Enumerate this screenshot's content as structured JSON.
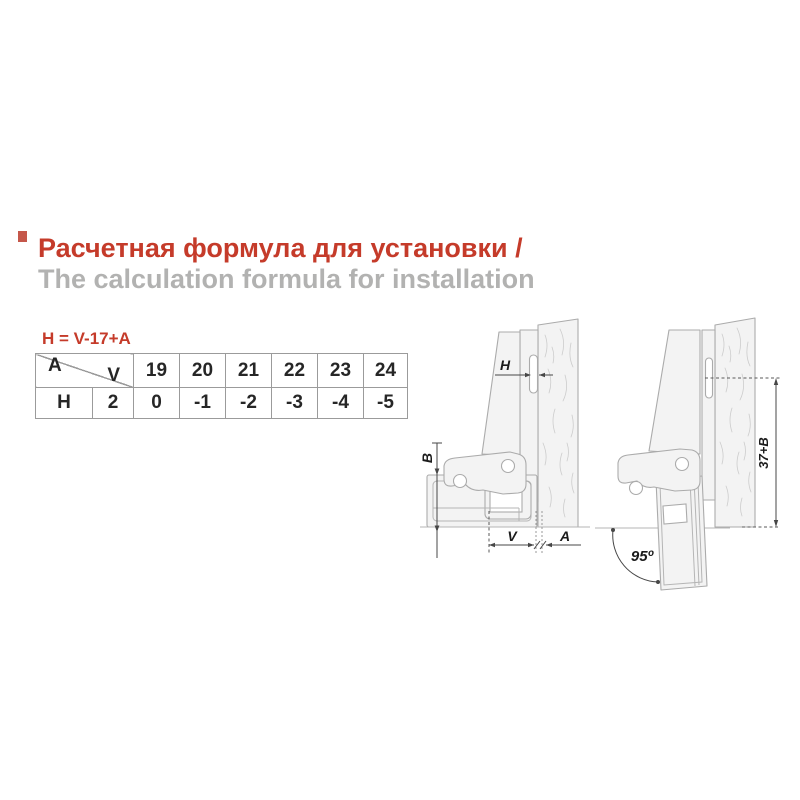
{
  "header": {
    "title_ru": "Расчетная формула для установки /",
    "title_en": "The calculation formula for installation"
  },
  "formula": "H = V-17+A",
  "table": {
    "corner_top_left": "A",
    "corner_bottom_right": "V",
    "v_values": [
      "19",
      "20",
      "21",
      "22",
      "23",
      "24"
    ],
    "row_label": "H",
    "row_first_value": "2",
    "h_values": [
      "0",
      "-1",
      "-2",
      "-3",
      "-4",
      "-5"
    ]
  },
  "diagram_closed": {
    "label_h": "H",
    "label_b": "B",
    "label_v": "V",
    "label_a": "A"
  },
  "diagram_open": {
    "label_height": "37+B",
    "label_angle": "95º"
  },
  "colors": {
    "accent_red": "#c53b2a",
    "subtitle_gray": "#b2b2b1",
    "drawing_gray": "#ababab",
    "dimension_dark": "#474747"
  }
}
